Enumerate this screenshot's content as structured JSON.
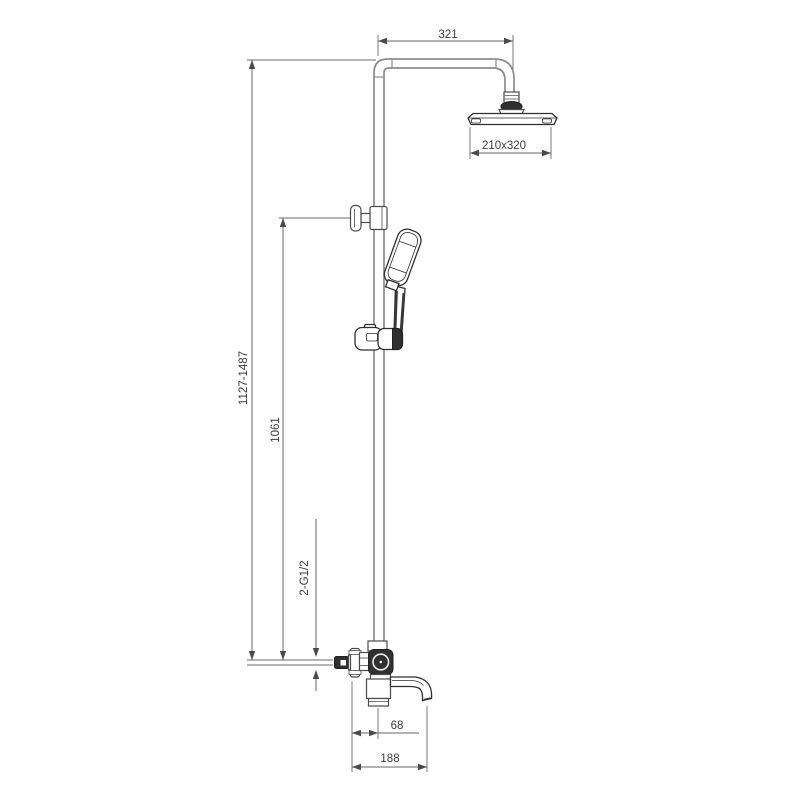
{
  "drawing": {
    "background": "#ffffff",
    "colors": {
      "pipe_outline": "#8c8c8c",
      "component_outline": "#2f2f2f",
      "dimension_lines": "#646464",
      "label_text": "#3c3c3c",
      "dark_parts": "#303030"
    },
    "labels": {
      "arm_reach": "321",
      "overhead_size": "210x320",
      "overall_height": "1127-1487",
      "riser_height": "1061",
      "inlet_thread": "2-G1/2",
      "spout_offset": "68",
      "spout_reach": "188"
    }
  }
}
